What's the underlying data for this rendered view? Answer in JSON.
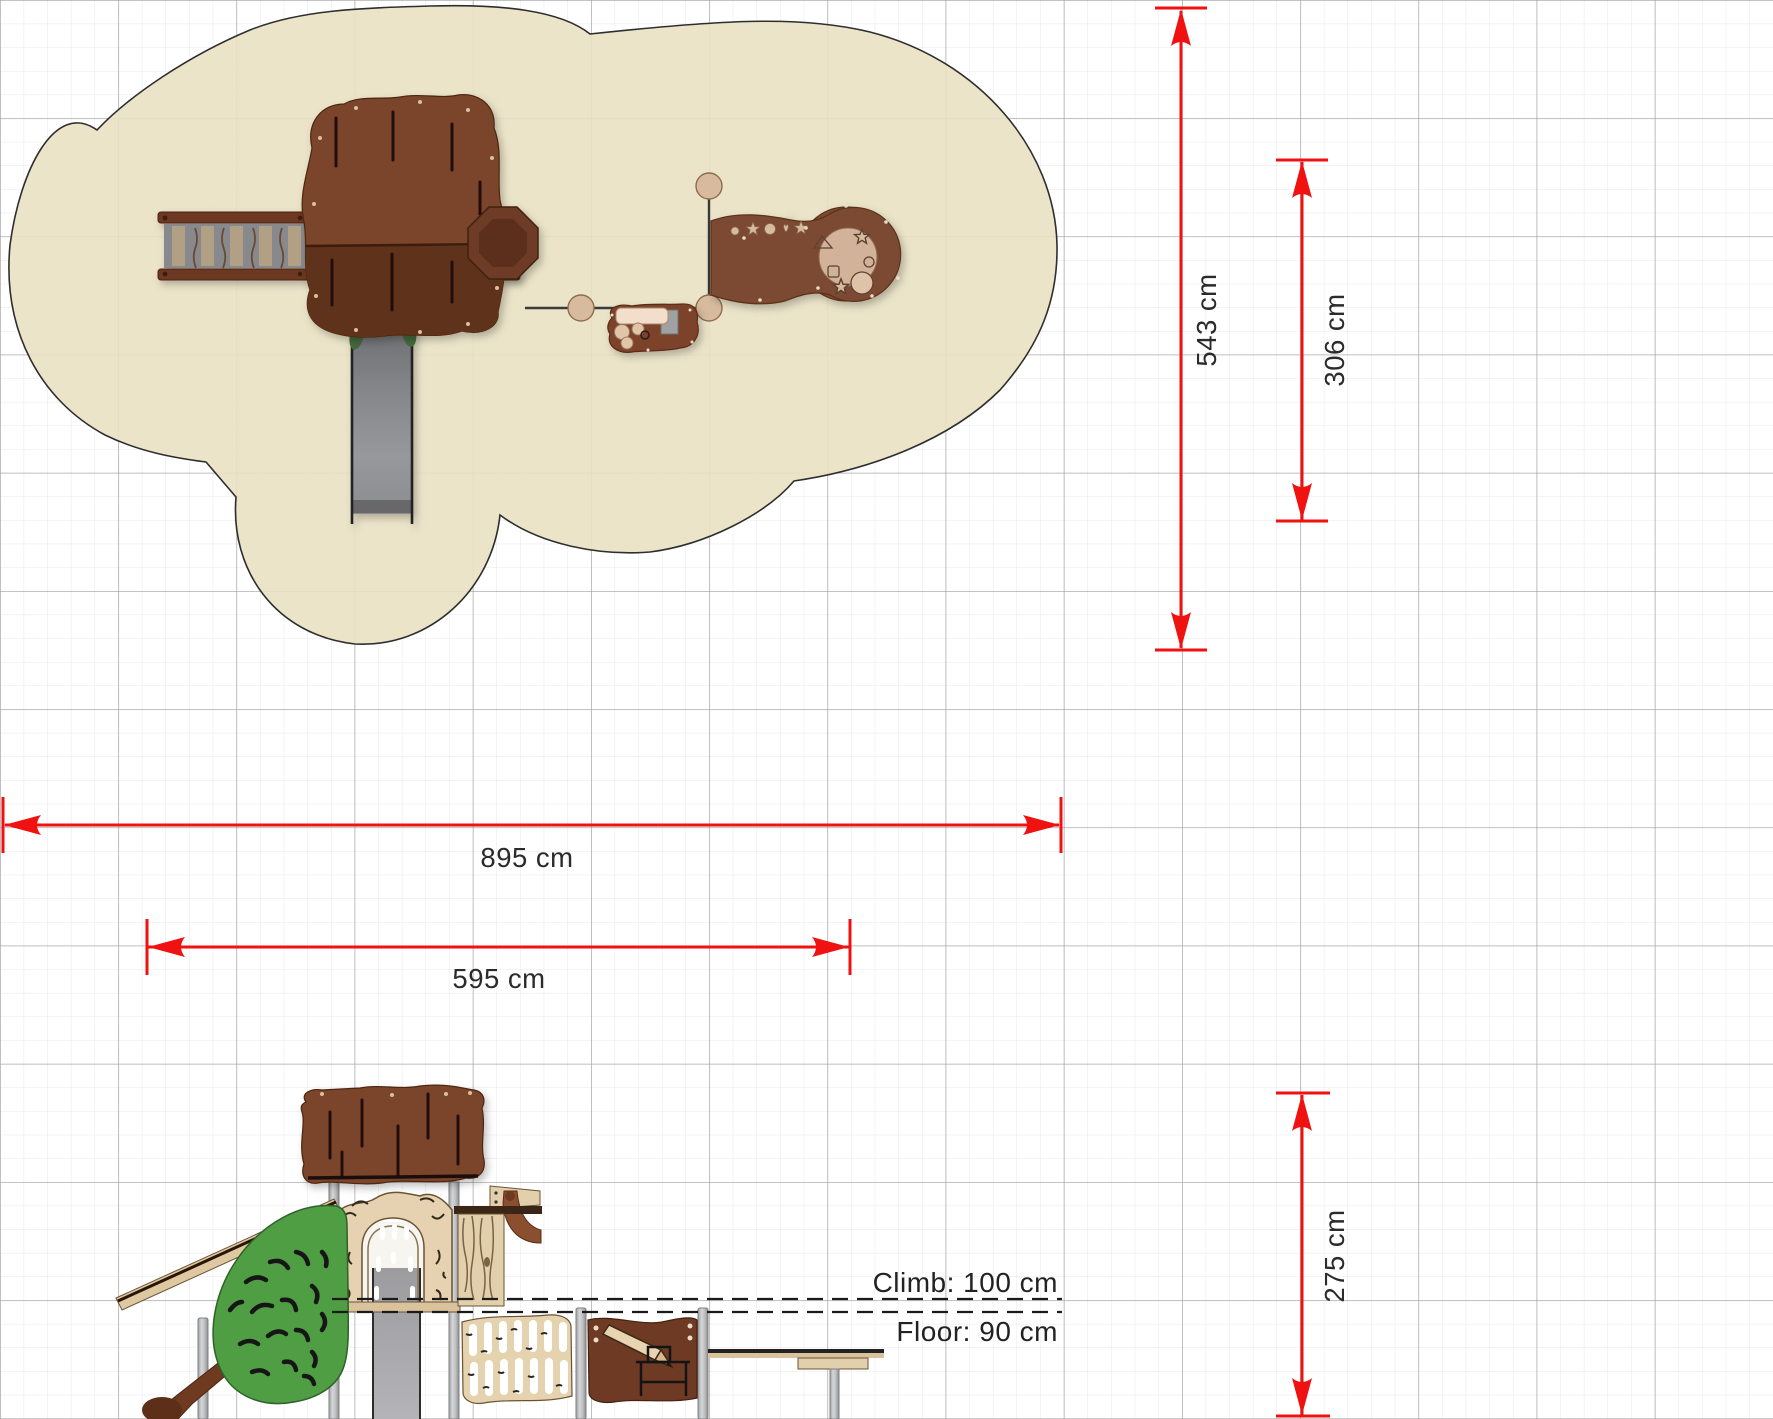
{
  "colors": {
    "dimension_red": "#f01111",
    "safety_surface": "#e9e1c3",
    "surface_outline": "#2e2e2e",
    "grid_major": "#9f9fa0",
    "grid_minor": "#e7e7e8",
    "wood_dark_brown": "#7a442b",
    "wood_panel_brown": "#6e3a23",
    "wood_tan": "#e6d2b0",
    "leaf_green": "#4f9e43",
    "slide_gray": "#8a8b8e",
    "post_gray": "#b5b6b8",
    "text_dark": "#2b2b2b"
  },
  "top_view": {
    "objects": [
      "safety-surface",
      "climbing-ramp",
      "tree-canopy",
      "slide",
      "crow-nest-platform",
      "sand-play-table",
      "connector-frame"
    ]
  },
  "side_view": {
    "objects": [
      "tree-canopy",
      "trunk-facade-arch",
      "slide",
      "leaf-climbing-wall",
      "branch",
      "viewing-scope",
      "net-climber-panel",
      "activity-panel-pencil",
      "play-table",
      "steel-posts"
    ]
  },
  "dimensions": {
    "total_depth": {
      "label": "543 cm",
      "value_cm": 543,
      "orientation": "vertical"
    },
    "unit_depth": {
      "label": "306 cm",
      "value_cm": 306,
      "orientation": "vertical"
    },
    "total_length": {
      "label": "895 cm",
      "value_cm": 895,
      "orientation": "horizontal"
    },
    "unit_length": {
      "label": "595 cm",
      "value_cm": 595,
      "orientation": "horizontal"
    },
    "total_height": {
      "label": "275 cm",
      "value_cm": 275,
      "orientation": "vertical"
    }
  },
  "reference_lines": {
    "climb": {
      "label": "Climb: 100 cm",
      "value_cm": 100
    },
    "floor": {
      "label": "Floor: 90 cm",
      "value_cm": 90
    }
  }
}
